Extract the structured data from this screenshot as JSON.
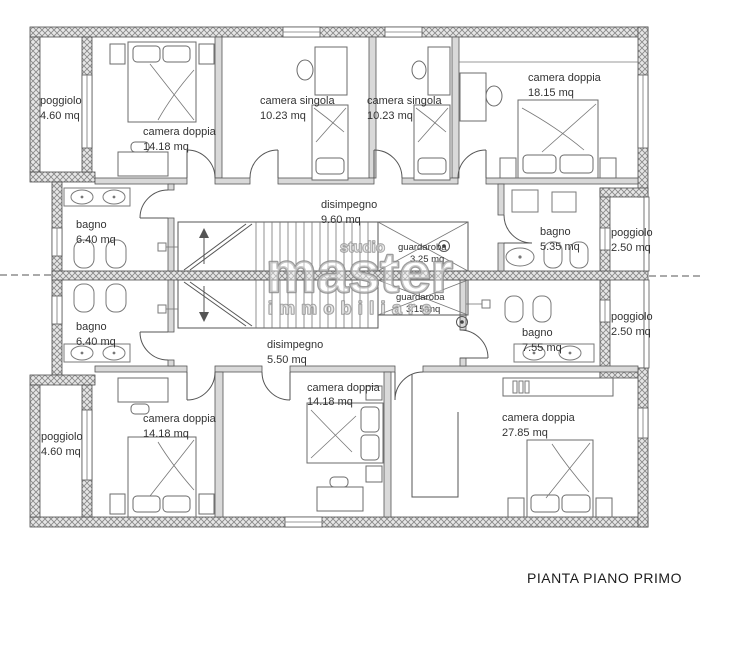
{
  "title": "PIANTA PIANO PRIMO",
  "watermark": {
    "studio": "studio",
    "master": "master",
    "immobiliare": "immobiliare"
  },
  "colors": {
    "wall_hatch": "#8a8a8a",
    "line": "#4d4d4d",
    "label": "#333333",
    "watermark": "#8d8d8d"
  },
  "rooms": [
    {
      "name": "poggiolo",
      "area": "4.60 mq"
    },
    {
      "name": "camera doppia",
      "area": "14.18 mq"
    },
    {
      "name": "camera singola",
      "area": "10.23 mq"
    },
    {
      "name": "camera singola",
      "area": "10.23 mq"
    },
    {
      "name": "camera doppia",
      "area": "18.15 mq"
    },
    {
      "name": "bagno",
      "area": "6.40 mq"
    },
    {
      "name": "disimpegno",
      "area": "9.60 mq"
    },
    {
      "name": "guardaroba",
      "area": "3.25 mq"
    },
    {
      "name": "bagno",
      "area": "5.35 mq"
    },
    {
      "name": "poggiolo",
      "area": "2.50 mq"
    },
    {
      "name": "bagno",
      "area": "6.40 mq"
    },
    {
      "name": "disimpegno",
      "area": "5.50 mq"
    },
    {
      "name": "guardaroba",
      "area": "3.15 mq"
    },
    {
      "name": "bagno",
      "area": "7.55 mq"
    },
    {
      "name": "poggiolo",
      "area": "2.50 mq"
    },
    {
      "name": "poggiolo",
      "area": "4.60 mq"
    },
    {
      "name": "camera doppia",
      "area": "14.18 mq"
    },
    {
      "name": "camera doppia",
      "area": "14.18 mq"
    },
    {
      "name": "camera doppia",
      "area": "27.85 mq"
    }
  ]
}
